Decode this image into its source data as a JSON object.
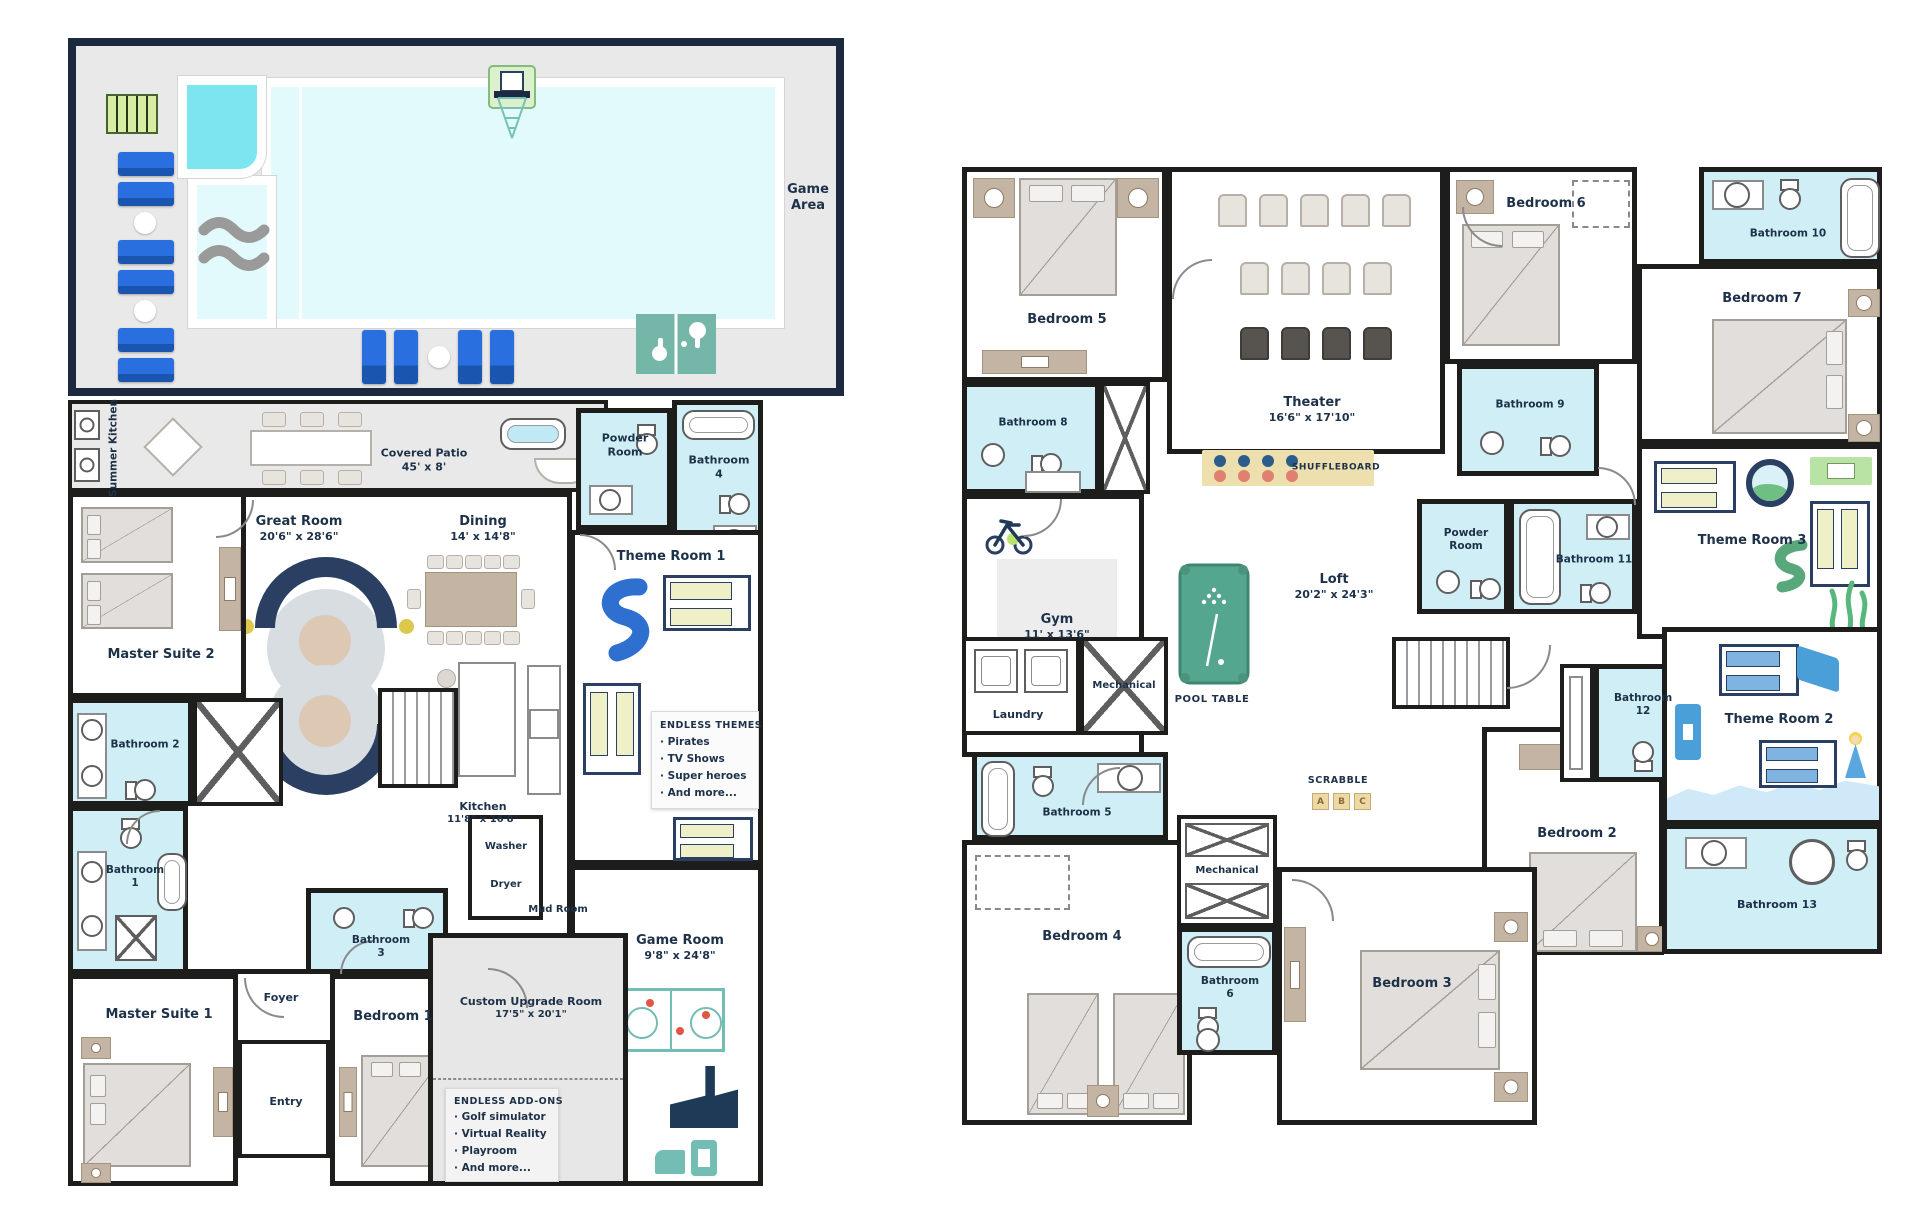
{
  "title": "Two-story vacation home floor plan with pool game area",
  "colors": {
    "wall": "#1d1d1b",
    "label_text": "#1d3149",
    "bathroom_fill": "#cfeef6",
    "patio_fill": "#e9e9e9",
    "pool_water": "#e2fafc",
    "spa_water": "#7de5f0",
    "pool_border_navy": "#1b2a40",
    "lounge_chair_blue": "#2a6fe0",
    "teal_games": "#74bdb4",
    "pool_table_green": "#55a68f",
    "shuffleboard_tan": "#eedfae",
    "sofa_navy": "#2b3f63",
    "furniture_tan": "#c3b4a3",
    "accent_yellow": "#dcc84d",
    "slide_blue": "#2f6fd0"
  },
  "pool_area": {
    "label": "Game Area"
  },
  "floor1": {
    "summer_kitchen": {
      "name": "Summer Kitchen"
    },
    "covered_patio": {
      "name": "Covered Patio",
      "dims": "45' x 8'"
    },
    "powder_room": {
      "name": "Powder Room"
    },
    "bathroom_4": {
      "name": "Bathroom 4"
    },
    "great_room": {
      "name": "Great Room",
      "dims": "20'6\" x 28'6\""
    },
    "dining": {
      "name": "Dining",
      "dims": "14' x 14'8\""
    },
    "kitchen": {
      "name": "Kitchen",
      "dims": "11'8\" x 16'8\""
    },
    "master_suite_2": {
      "name": "Master Suite 2"
    },
    "bathroom_2": {
      "name": "Bathroom 2"
    },
    "bathroom_1": {
      "name": "Bathroom 1"
    },
    "master_suite_1": {
      "name": "Master Suite 1"
    },
    "foyer": {
      "name": "Foyer"
    },
    "entry": {
      "name": "Entry"
    },
    "bedroom_1": {
      "name": "Bedroom 1"
    },
    "bathroom_3": {
      "name": "Bathroom 3"
    },
    "theme_room_1": {
      "name": "Theme Room 1"
    },
    "endless_themes": {
      "title": "ENDLESS THEMES",
      "items": [
        "· Pirates",
        "· TV Shows",
        "· Super heroes",
        "· And more..."
      ]
    },
    "washer": {
      "name": "Washer"
    },
    "dryer": {
      "name": "Dryer"
    },
    "mud_room": {
      "name": "Mud Room"
    },
    "game_room": {
      "name": "Game Room",
      "dims": "9'8\" x 24'8\""
    },
    "custom_upgrade_room": {
      "name": "Custom Upgrade Room",
      "dims": "17'5\" x 20'1\""
    },
    "endless_addons": {
      "title": "ENDLESS ADD-ONS",
      "items": [
        "· Golf simulator",
        "· Virtual Reality",
        "· Playroom",
        "· And more..."
      ]
    }
  },
  "floor2": {
    "bedroom_5": {
      "name": "Bedroom 5"
    },
    "bathroom_8": {
      "name": "Bathroom 8"
    },
    "theater": {
      "name": "Theater",
      "dims": "16'6\" x 17'10\""
    },
    "bedroom_6": {
      "name": "Bedroom 6"
    },
    "bathroom_10": {
      "name": "Bathroom 10"
    },
    "bedroom_7": {
      "name": "Bedroom 7"
    },
    "bathroom_9": {
      "name": "Bathroom 9"
    },
    "theme_room_3": {
      "name": "Theme Room 3"
    },
    "powder_room": {
      "name": "Powder Room"
    },
    "bathroom_11": {
      "name": "Bathroom 11"
    },
    "gym": {
      "name": "Gym",
      "dims": "11' x 13'6\""
    },
    "shuffleboard": {
      "name": "SHUFFLEBOARD"
    },
    "loft": {
      "name": "Loft",
      "dims": "20'2\" x 24'3\""
    },
    "pool_table": {
      "name": "POOL TABLE"
    },
    "laundry": {
      "name": "Laundry"
    },
    "mechanical_upper": {
      "name": "Mechanical"
    },
    "bathroom_12": {
      "name": "Bathroom 12"
    },
    "theme_room_2": {
      "name": "Theme Room 2"
    },
    "bathroom_5": {
      "name": "Bathroom 5"
    },
    "mechanical_lower": {
      "name": "Mechanical"
    },
    "scrabble": {
      "name": "SCRABBLE",
      "tiles": [
        "A",
        "B",
        "C"
      ]
    },
    "bedroom_2": {
      "name": "Bedroom 2"
    },
    "bedroom_4": {
      "name": "Bedroom 4"
    },
    "bathroom_6": {
      "name": "Bathroom 6"
    },
    "bedroom_3": {
      "name": "Bedroom 3"
    },
    "bathroom_13": {
      "name": "Bathroom 13"
    }
  }
}
